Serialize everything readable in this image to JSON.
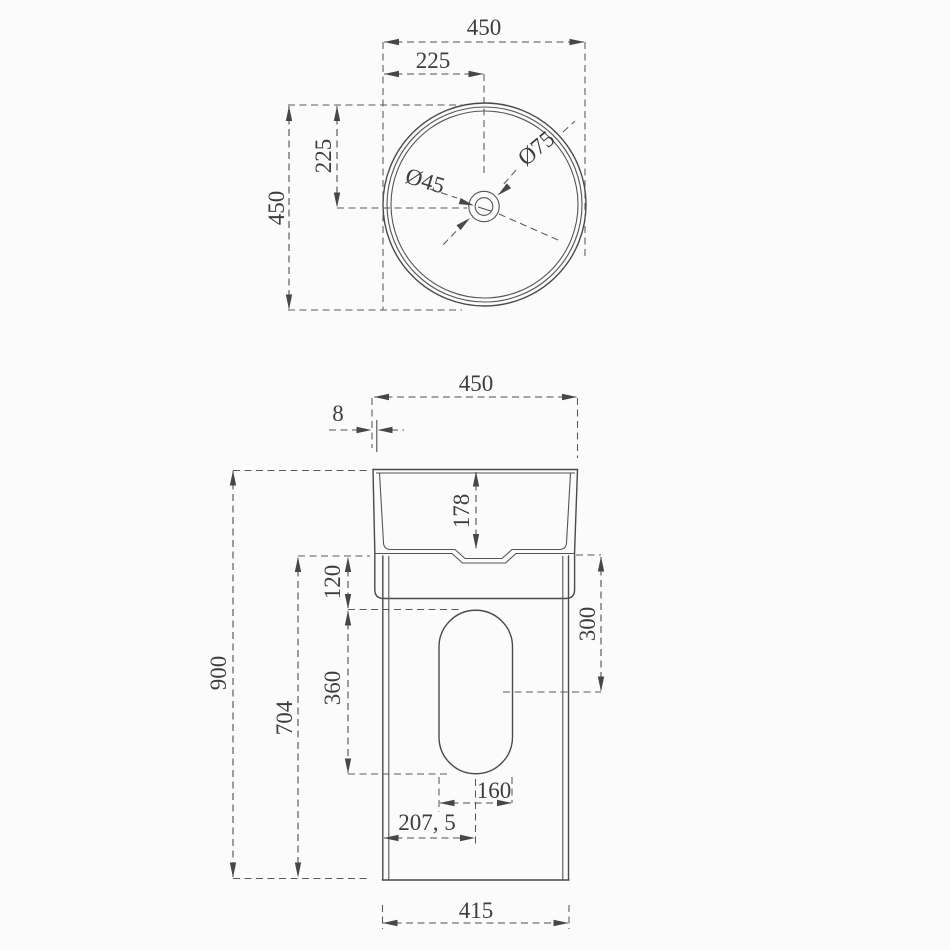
{
  "drawing": {
    "type": "pedestal-washbasin-dimension-drawing",
    "colors": {
      "background": "#fbfbfb",
      "line": "#4a4a4a",
      "text": "#3d3d3d"
    },
    "top_view": {
      "overall_width": "450",
      "faucet_center_from_left": "225",
      "overall_depth": "450",
      "faucet_center_from_top": "225",
      "drain_hole_diameter": "Ø45",
      "faucet_hole_diameter": "Ø75"
    },
    "front_view": {
      "basin_top_width": "450",
      "rim_lip_offset": "8",
      "basin_height": "178",
      "overall_height": "900",
      "pedestal_height": "704",
      "rim_to_cutout_top": "120",
      "cutout_height": "360",
      "rim_to_cutout_center": "300",
      "cutout_width": "160",
      "cutout_center_from_edge": "207, 5",
      "base_width": "415"
    }
  }
}
